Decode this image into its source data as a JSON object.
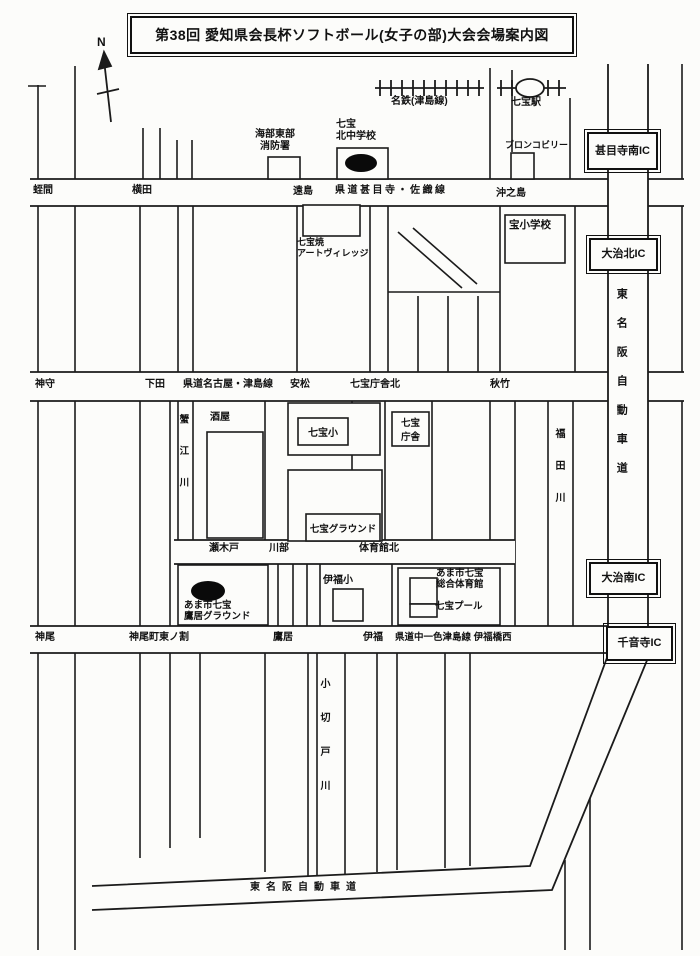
{
  "title": "第38回 愛知県会長杯ソフトボール(女子の部)大会会場案内図",
  "compass": {
    "north": "N"
  },
  "railway": {
    "line": "名鉄(津島線)",
    "station": "七宝駅"
  },
  "roads": {
    "jimokuji_saori": "県道甚目寺・佐織線",
    "nagoya_tsushima": "県道名古屋・津島線",
    "nakaisshiki_tsushima": "県道中一色津島線 伊福橋西",
    "tomeihan_side": "東名阪自動車道",
    "tomeihan_bottom": "東名阪自動車道"
  },
  "interchanges": {
    "jimokuji_minami": "甚目寺南IC",
    "oharu_kita": "大治北IC",
    "oharu_minami": "大治南IC",
    "senonji": "千音寺IC"
  },
  "intersections": {
    "hiruma": "蛭間",
    "yokota": "横田",
    "toshima": "遠島",
    "okinoshima": "沖之島",
    "kamori": "神守",
    "shimoda": "下田",
    "yasumatsu": "安松",
    "chosha_kita": "七宝庁舎北",
    "akitake": "秋竹",
    "segido": "瀬木戸",
    "kawabe": "川部",
    "taiikukan_kita": "体育館北",
    "kamio": "神尾",
    "kamio_higashinowari": "神尾町東ノ割",
    "takasue": "鷹居",
    "ifuku": "伊福"
  },
  "rivers": {
    "kanie": "蟹江川",
    "fukuta": "福田川",
    "kokirido": "小切戸川"
  },
  "places": {
    "fire_station": {
      "line1": "海部東部",
      "line2": "消防署"
    },
    "kita_junior_high": {
      "line1": "七宝",
      "line2": "北中学校"
    },
    "bronco_billy": "ブロンコビリー",
    "art_village": {
      "line1": "七宝焼",
      "line2": "アートヴィレッジ"
    },
    "takara_elementary": "宝小学校",
    "sakaya": "酒屋",
    "shippo_elementary": "七宝小",
    "shippo_chosha": {
      "line1": "七宝",
      "line2": "庁舎"
    },
    "shippo_ground": "七宝グラウンド",
    "ifuku_elementary": "伊福小",
    "sogo_taiikukan": {
      "line1": "あま市七宝",
      "line2": "総合体育館"
    },
    "shippo_pool": "七宝プール",
    "takasue_ground": {
      "line1": "あま市七宝",
      "line2": "鷹居グラウンド"
    }
  }
}
